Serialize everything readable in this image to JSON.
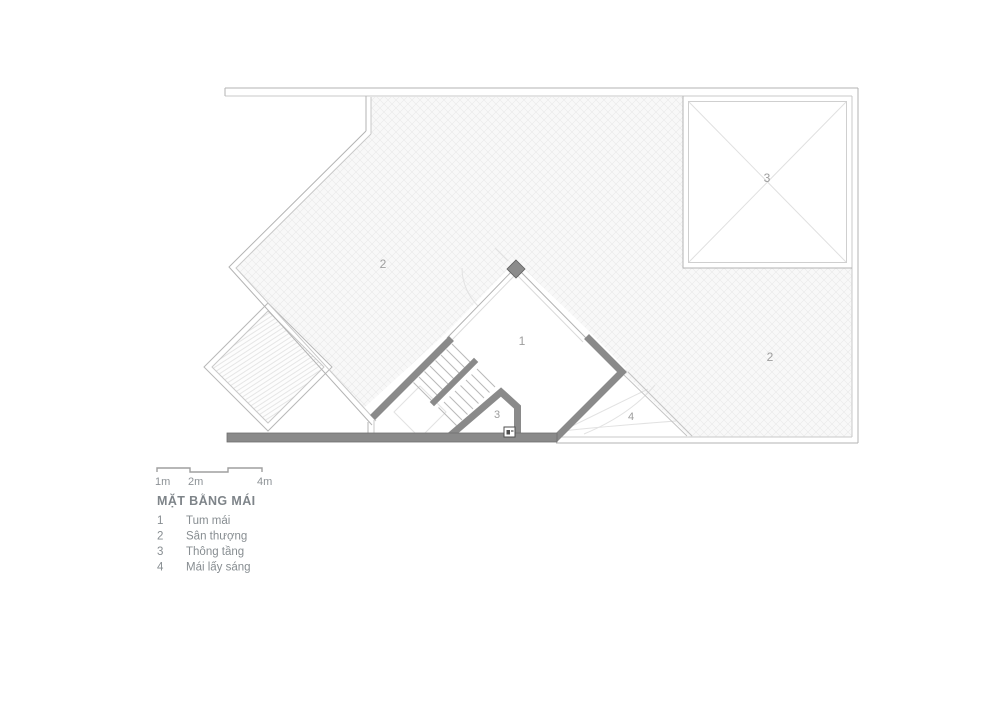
{
  "drawing": {
    "type": "architectural-roof-plan",
    "plan_labels": {
      "tum_mai": "1",
      "terrace_left": "2",
      "terrace_right": "2",
      "skylight_void": "3",
      "stair_void": "3",
      "skylight_roof": "4"
    }
  },
  "scale_bar": {
    "labels": [
      "1m",
      "2m",
      "4m"
    ]
  },
  "legend": {
    "title": "MẶT BẰNG MÁI",
    "items": [
      {
        "num": "1",
        "label": "Tum mái"
      },
      {
        "num": "2",
        "label": "Sân thượng"
      },
      {
        "num": "3",
        "label": "Thông tầng"
      },
      {
        "num": "4",
        "label": "Mái lấy sáng"
      }
    ]
  },
  "colors": {
    "wall_gray": "#8a8a8a",
    "boundary_line": "#b3b3b3",
    "hatch_line": "#e9e9e9",
    "text_gray": "#8d9296"
  }
}
